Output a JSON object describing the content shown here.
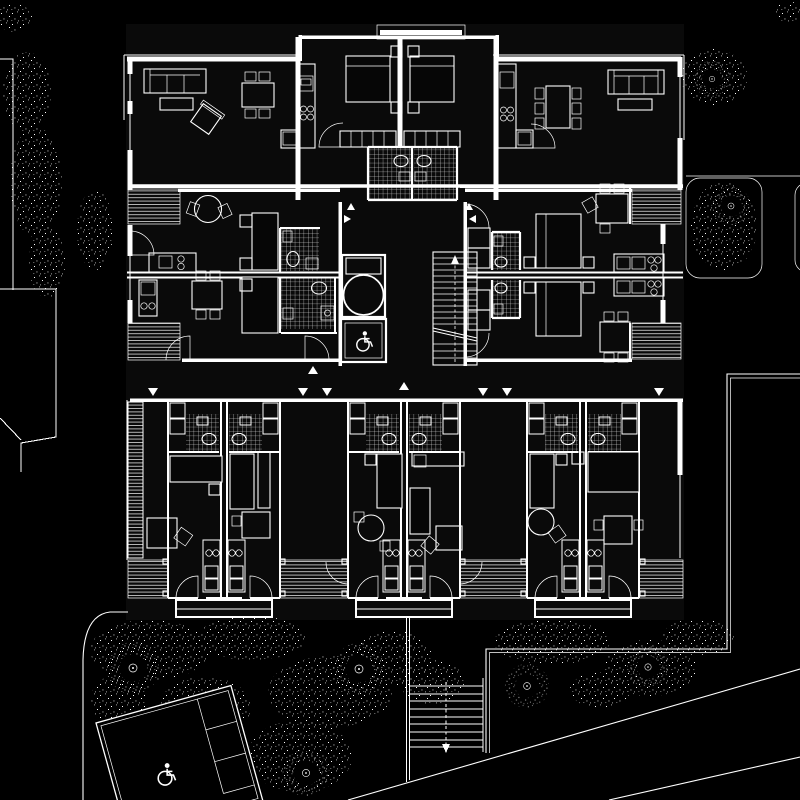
{
  "document": {
    "type": "architectural-floor-plan",
    "title": "Apartment building floor plan with site",
    "aria_label": "Black and white architectural floor plan: white CAD linework on black showing three upper apartments, four middle studio units around a core with elevator, accessible lift and staircase, six lower rooms with tiled bathrooms and balcony decks, gardens with stippled trees, a tilted outbuilding with wheelchair symbol, external stairs and diagonal footpaths",
    "visible_text": []
  },
  "colors": {
    "background": "#000000",
    "line": "#ffffff",
    "interior": "#0a0a0a",
    "furniture": "#060606"
  },
  "building": {
    "top_apartments": 3,
    "middle_studio_units": 4,
    "bottom_rooms": 6,
    "core_elements": [
      "staircase",
      "elevator",
      "accessible-lift"
    ],
    "bathrooms_tiled": 10,
    "balcony_decks": 8,
    "porches": 3
  },
  "site": {
    "features": [
      "west-boundary-line",
      "neighbor-building-outline",
      "south-west-garden",
      "south-east-garden",
      "tilted-outbuilding",
      "external-stair",
      "diagonal-footpaths",
      "planters",
      "garden-wall"
    ]
  },
  "icons": [
    {
      "name": "wheelchair-icon",
      "count": 2
    },
    {
      "name": "elevator-circle-icon",
      "count": 1
    },
    {
      "name": "stair-arrow-icon",
      "count": 2
    },
    {
      "name": "entry-triangle-marker",
      "count": 12
    },
    {
      "name": "tree-ring-icon",
      "count": 7
    },
    {
      "name": "hob-burner-icon",
      "count": 14
    },
    {
      "name": "wc-fixture-icon",
      "count": 10
    },
    {
      "name": "door-swing-arc",
      "count": 14
    }
  ],
  "patterns": {
    "bathroom_floor": "crosshatch tile grid",
    "deck_floor": "parallel plank stripes",
    "vegetation": "stipple dots"
  }
}
